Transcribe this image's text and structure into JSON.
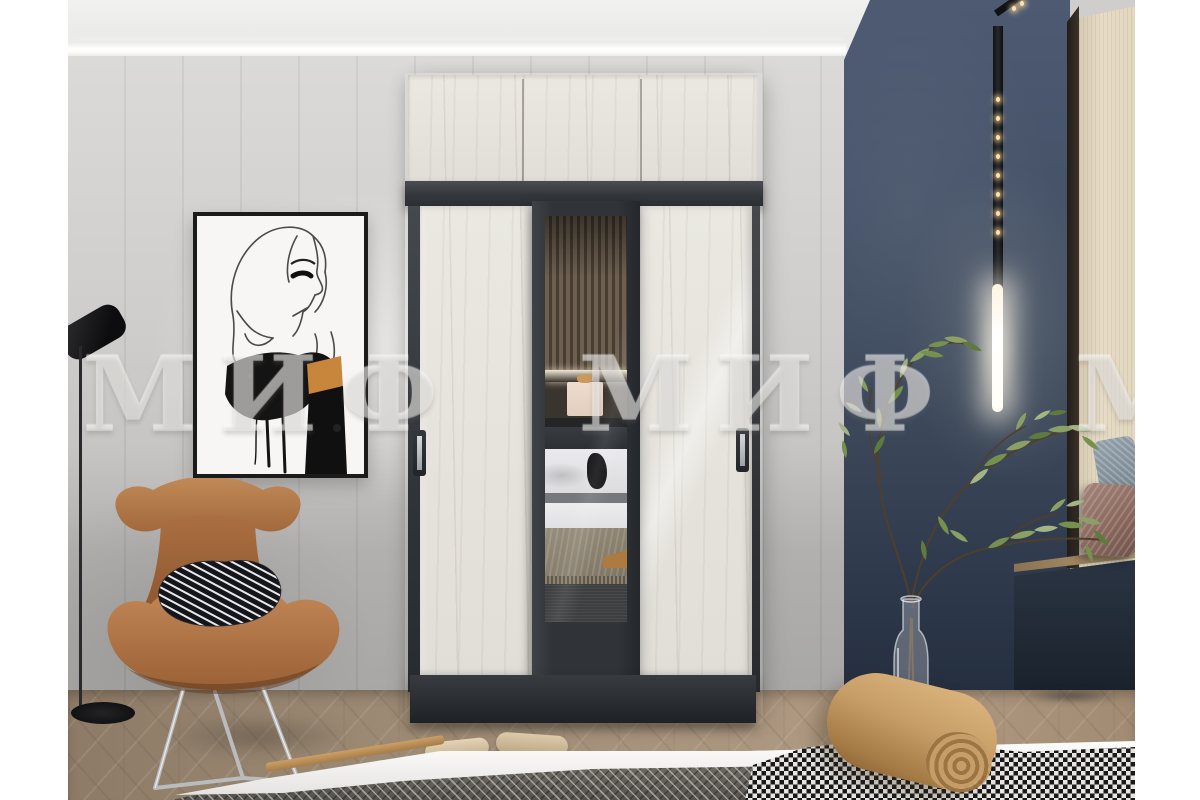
{
  "watermark": {
    "text": "МИФ МИФ МИФ МИФ",
    "brand": "МИФ"
  },
  "scene": {
    "type": "interior product photograph",
    "description": "Bedroom with a three-door sliding wardrobe in white craft oak and graphite with a mirrored centre door, terracotta wing chair, fashion sketch wall art, navy accent wall with vertical LED track light, olive branch in a glass bottle vase, window niche bench and a bed in the foreground",
    "objects": [
      "ceiling-cove-light",
      "grey-panelled-wall",
      "wall-art-fashion-sketch",
      "floor-lamp",
      "sliding-wardrobe",
      "wardrobe-top-cabinets",
      "mirror-door-reflection",
      "terracotta-wing-chair",
      "zebra-print-pillow",
      "navy-accent-wall",
      "led-track-light",
      "glass-bottle-vase",
      "olive-branch-plant",
      "window-niche-bench",
      "bench-pillows",
      "herringbone-wood-floor",
      "foreground-bed",
      "houndstooth-throw",
      "tan-bolster-pillow",
      "beige-slippers"
    ]
  },
  "palette": {
    "oak_door": "#e9e6e0",
    "graphite": "#34373b",
    "grey_wall": "#cfcecc",
    "navy_wall": "#3f4b5f",
    "chair_terracotta": "#b47847",
    "floor_wood": "#a08c75",
    "plant_green": "#8ba064",
    "led_glow": "#fff6e4",
    "bolster_tan": "#c69d66",
    "art_accent_orange": "#c8863d"
  }
}
